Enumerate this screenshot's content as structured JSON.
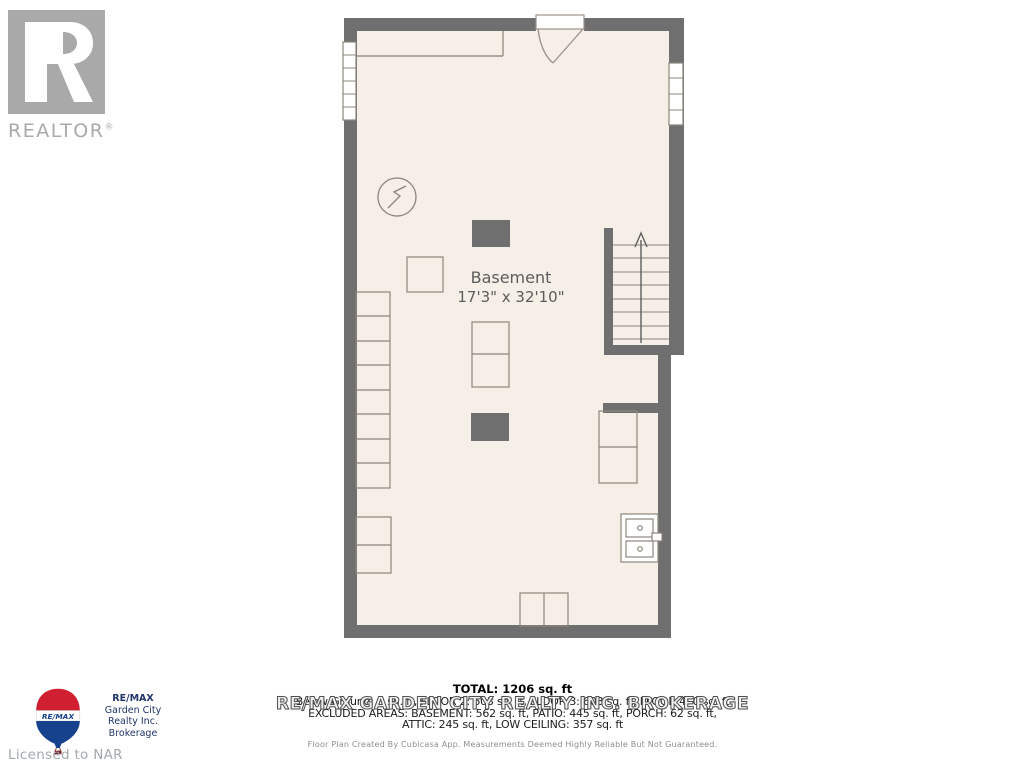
{
  "realtor_logo": {
    "text": "REALTOR",
    "registered": "®"
  },
  "remax_logo": {
    "balloon_text": "RE/MAX",
    "line1": "RE/MAX",
    "line2": "Garden City",
    "line3": "Realty Inc.",
    "line4": "Brokerage"
  },
  "footer_left": {
    "licensed": "Licensed to NAR"
  },
  "floorplan": {
    "room_label": "Basement",
    "room_dimensions": "17'3\" x 32'10\"",
    "stairs_direction": "up",
    "colors": {
      "wall": "#6f6f6f",
      "floor": "#f5efe8",
      "outline": "#8d857b"
    }
  },
  "summary": {
    "total": "TOTAL: 1206 sq. ft",
    "floors_line": "Below Ground: 0 sq. ft, FLOOR 2: 603 sq. ft, FLOOR 3: 603 sq. ft, FLOOR 4: 0 sq. ft",
    "excluded_line1": "EXCLUDED AREAS: BASEMENT: 562 sq. ft, PATIO: 445 sq. ft, PORCH: 62 sq. ft,",
    "excluded_line2": "ATTIC: 245 sq. ft, LOW CEILING: 357 sq. ft",
    "watermark": "RE/MAX GARDEN CITY REALTY INC. BROKERAGE",
    "disclaimer": "Floor Plan Created By Cubicasa App. Measurements Deemed Highly Reliable But Not Guaranteed."
  }
}
